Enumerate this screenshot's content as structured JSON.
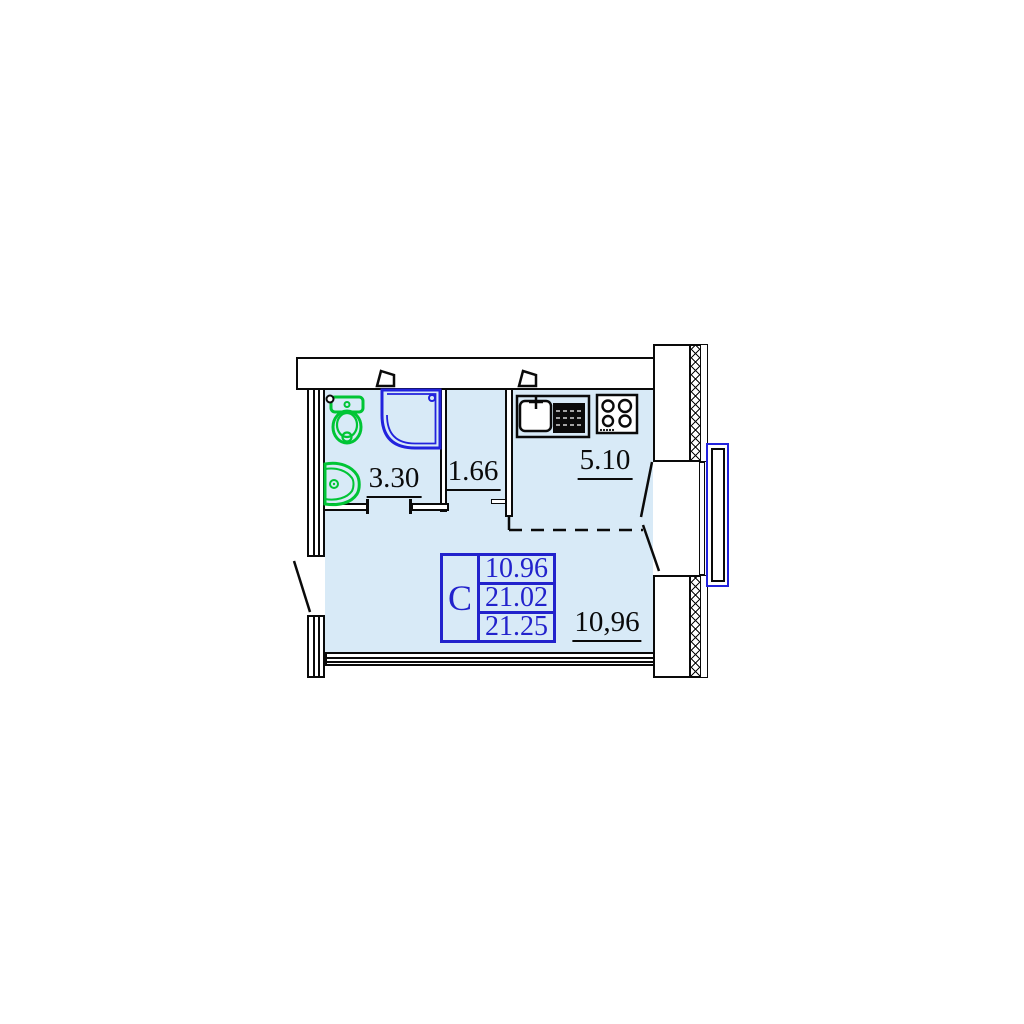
{
  "plan": {
    "unit_type_label": "С",
    "stats": [
      {
        "name": "living-area",
        "value": "10.96"
      },
      {
        "name": "total-area",
        "value": "21.02"
      },
      {
        "name": "total-area-with-balcony",
        "value": "21.25"
      }
    ],
    "rooms": [
      {
        "name": "bathroom",
        "area": "3.30"
      },
      {
        "name": "hallway",
        "area": "1.66"
      },
      {
        "name": "kitchen",
        "area": "5.10"
      },
      {
        "name": "living-room",
        "area": "10,96"
      }
    ],
    "fixtures": [
      "toilet",
      "washbasin",
      "shower",
      "kitchen-sink",
      "drainboard",
      "stove",
      "vent-shaft",
      "vent-shaft"
    ],
    "colors": {
      "room_fill": "#d8eaf7",
      "line": "#0a0a0a",
      "fixture_green": "#00c535",
      "fixture_blue": "#2222dd",
      "table_blue": "#2222cc"
    }
  }
}
